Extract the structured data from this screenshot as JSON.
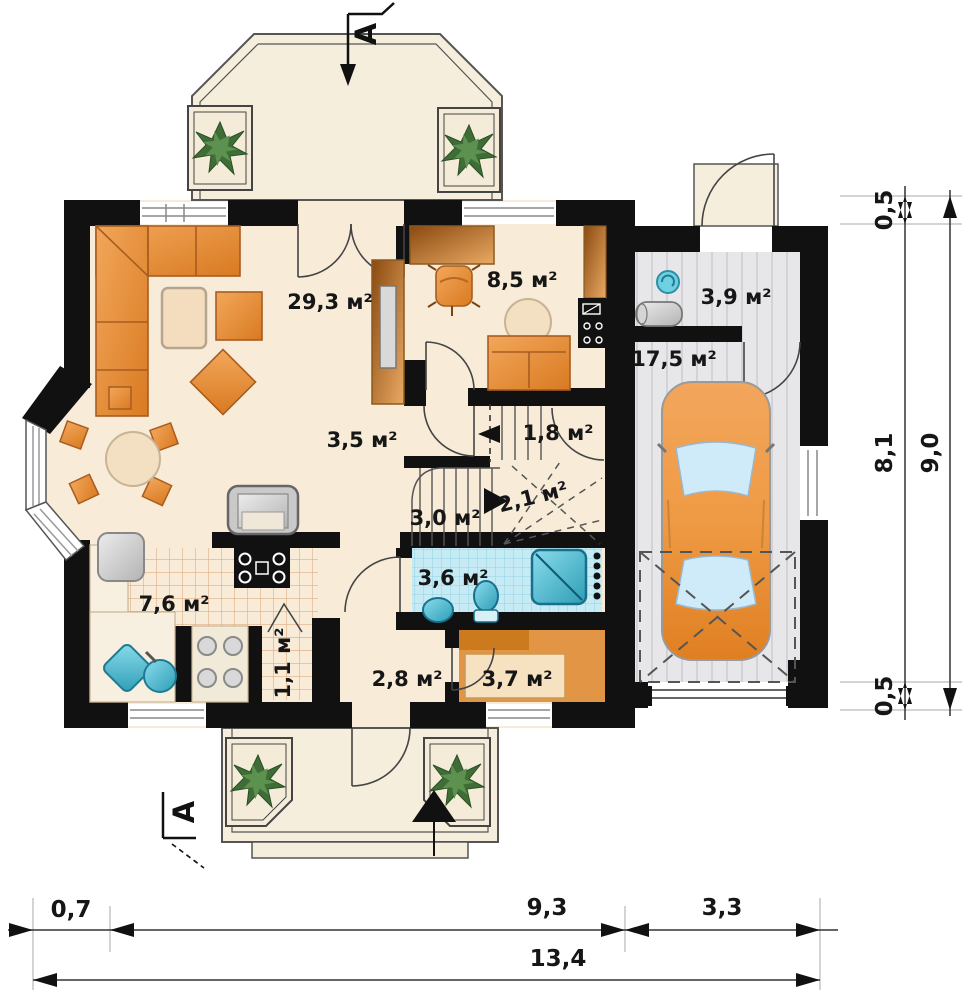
{
  "plan_type": "floor-plan",
  "rooms": {
    "living": {
      "label": "29,3 м²"
    },
    "study": {
      "label": "8,5 м²"
    },
    "hall": {
      "label": "3,5 м²"
    },
    "stairs_upper": {
      "label": "1,8 м²"
    },
    "stairs_mid": {
      "label": "2,1 м²"
    },
    "stairs_lower": {
      "label": "3,0 м²"
    },
    "bathroom": {
      "label": "3,6 м²"
    },
    "kitchen": {
      "label": "7,6 м²"
    },
    "pantry": {
      "label": "1,1 м²"
    },
    "vestibule": {
      "label": "2,8 м²"
    },
    "wardrobe": {
      "label": "3,7 м²"
    },
    "utility": {
      "label": "3,9 м²"
    },
    "garage": {
      "label": "17,5 м²"
    }
  },
  "section": {
    "marker": "A"
  },
  "dimensions": {
    "right_wall_top": "0,5",
    "right_inner": "8,1",
    "right_total": "9,0",
    "right_wall_bottom": "0,5",
    "bottom_bay": "0,7",
    "bottom_house": "9,3",
    "bottom_garage": "3,3",
    "bottom_total": "13,4"
  },
  "colors": {
    "wall": "#111111",
    "floor_cream": "#f8ecd9",
    "furniture_orange": "#e8913f",
    "tile_blue": "#c6ebf4",
    "garage_gray": "#e7e7ea",
    "fixture_teal": "#49bcd4",
    "plant_green": "#3f6d36"
  }
}
